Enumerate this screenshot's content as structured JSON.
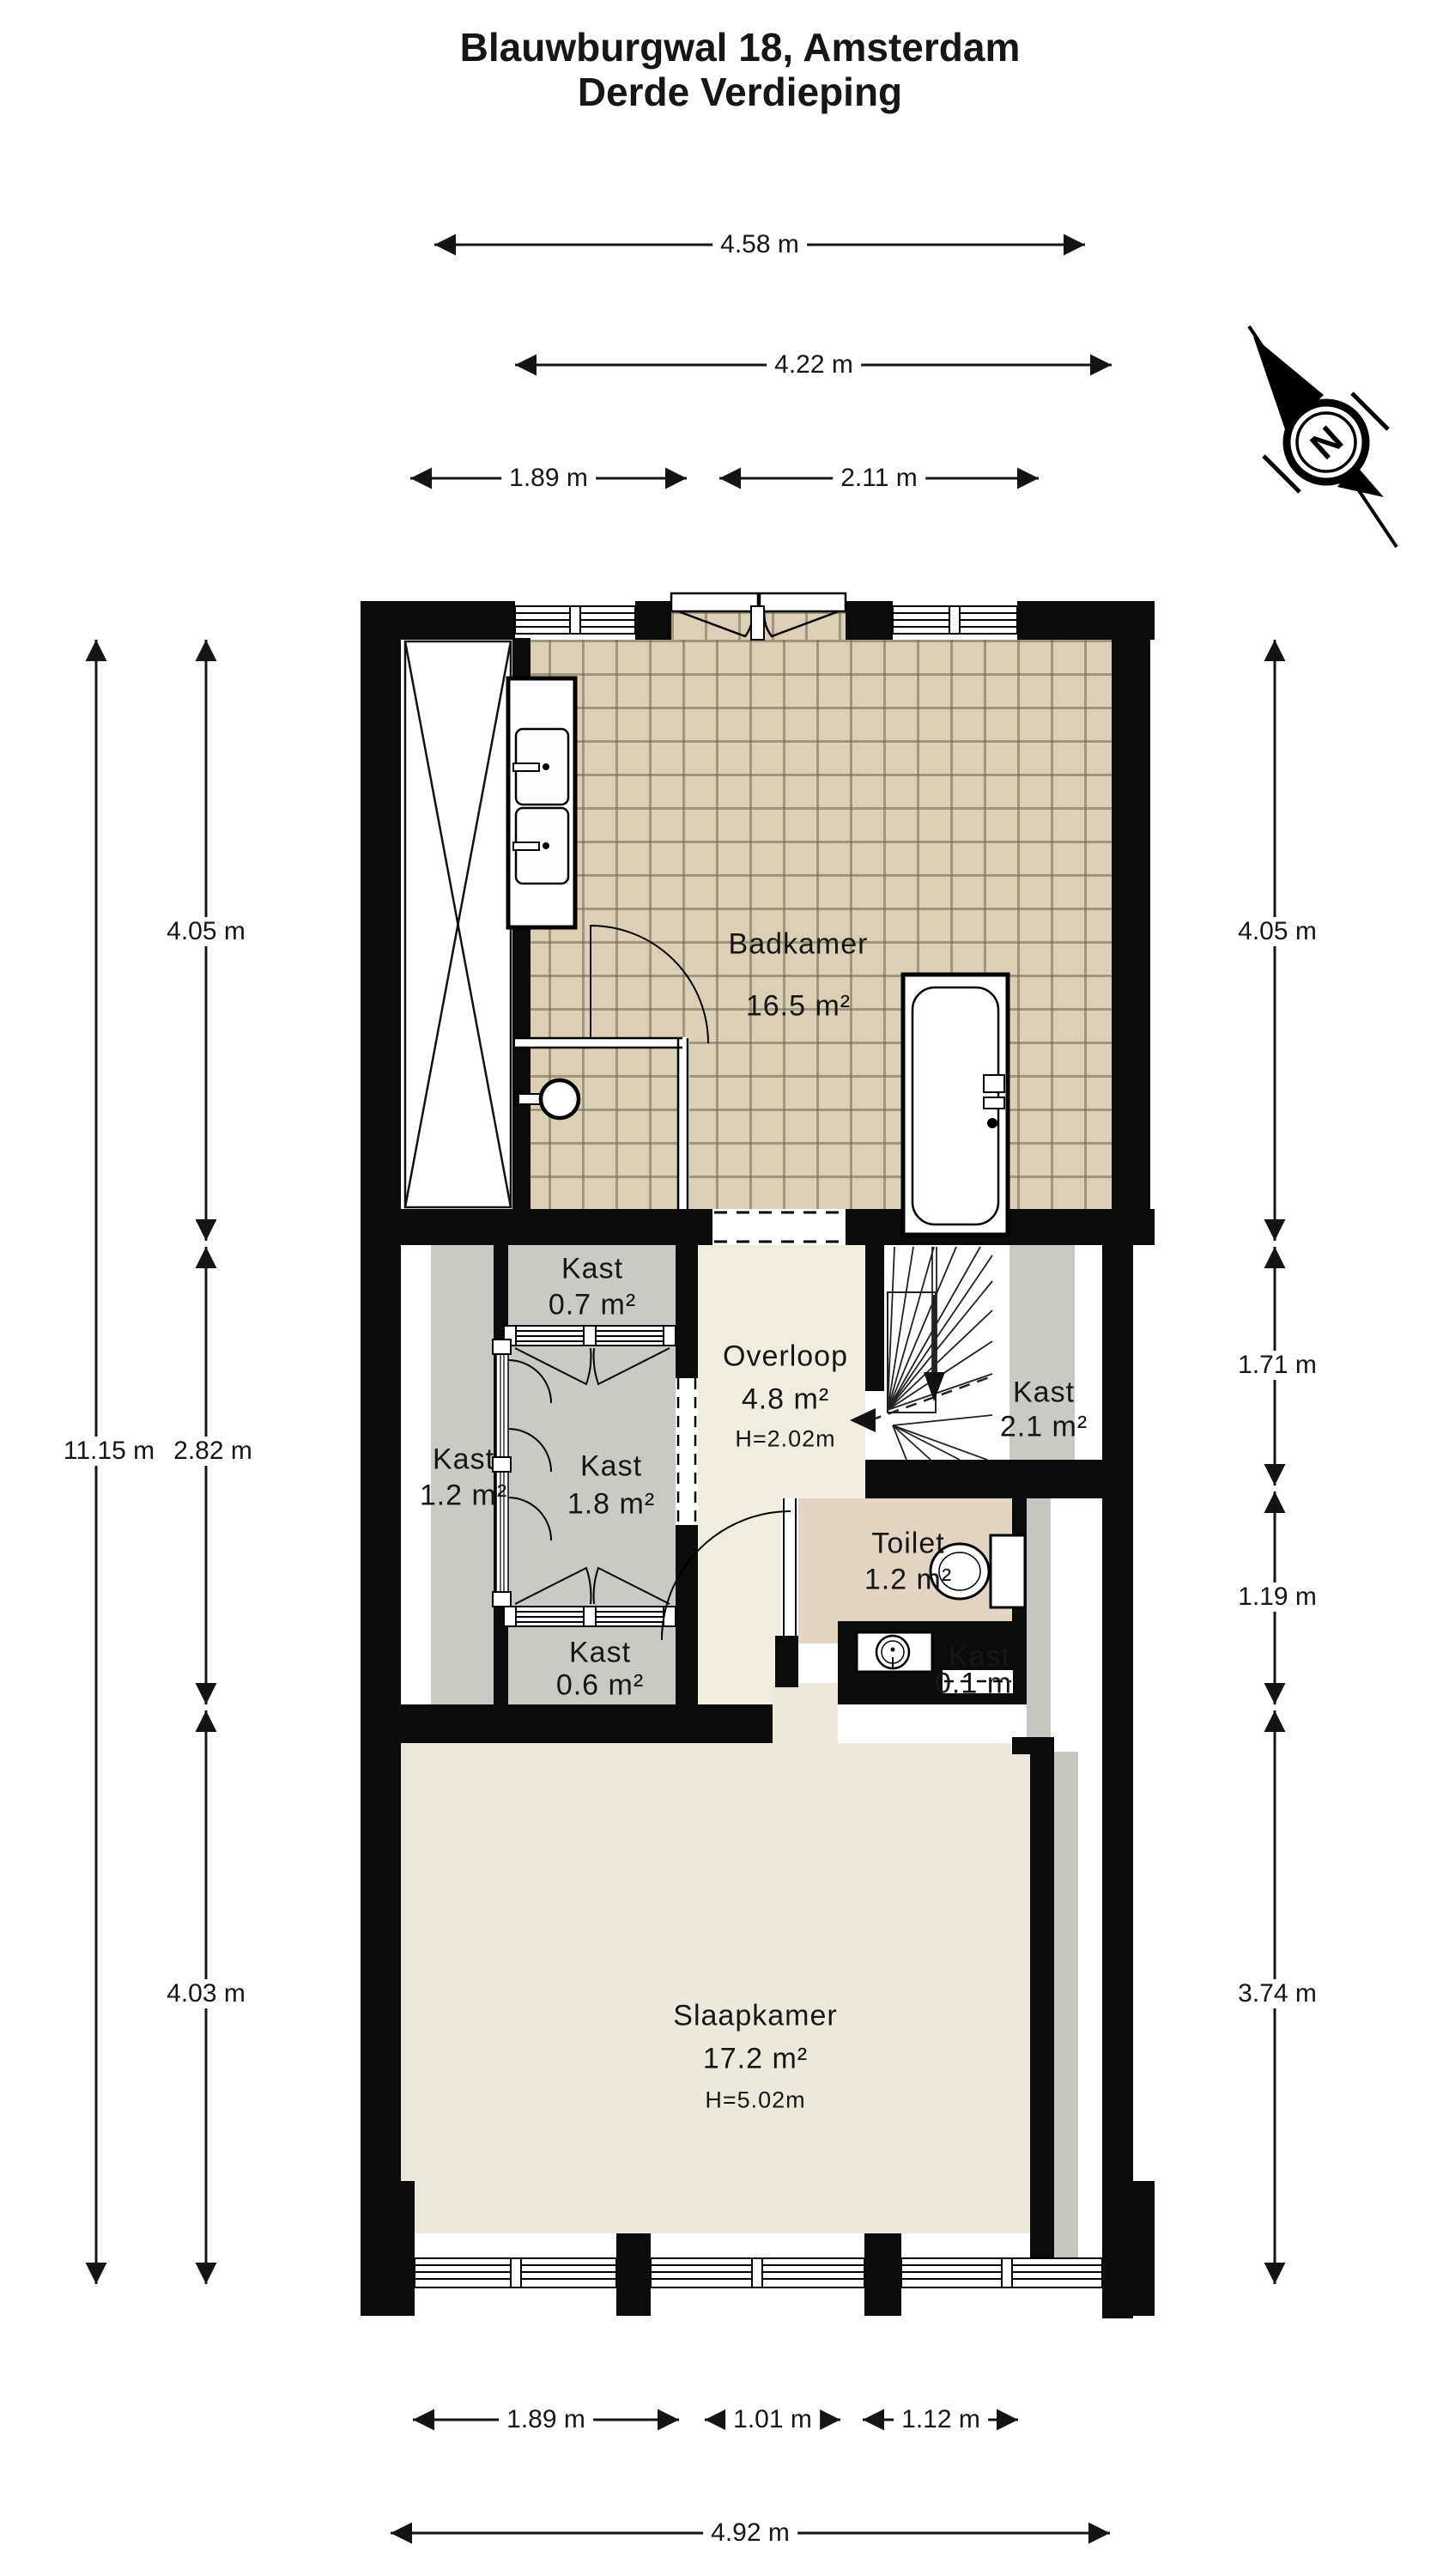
{
  "title": {
    "line1": "Blauwburgwal 18, Amsterdam",
    "line2": "Derde Verdieping"
  },
  "compass": {
    "letter": "N"
  },
  "rooms": {
    "badkamer": {
      "name": "Badkamer",
      "area": "16.5 m²"
    },
    "kast_07": {
      "name": "Kast",
      "area": "0.7 m²"
    },
    "kast_12": {
      "name": "Kast",
      "area": "1.2 m²"
    },
    "kast_18": {
      "name": "Kast",
      "area": "1.8 m²"
    },
    "kast_06": {
      "name": "Kast",
      "area": "0.6 m²"
    },
    "overloop": {
      "name": "Overloop",
      "area": "4.8 m²",
      "height": "H=2.02m"
    },
    "kast_21": {
      "name": "Kast",
      "area": "2.1 m²"
    },
    "toilet": {
      "name": "Toilet",
      "area": "1.2 m²"
    },
    "kast_01": {
      "name": "Kast",
      "area": "0.1 m"
    },
    "slaapkamer": {
      "name": "Slaapkamer",
      "area": "17.2 m²",
      "height": "H=5.02m"
    }
  },
  "dimensions": {
    "top": [
      "4.58 m",
      "4.22 m",
      "1.89 m",
      "2.11 m"
    ],
    "left": [
      "4.05 m",
      "11.15 m",
      "2.82 m",
      "4.03 m"
    ],
    "right": [
      "4.05 m",
      "1.71 m",
      "1.19 m",
      "3.74 m"
    ],
    "bottom": [
      "1.89 m",
      "1.01 m",
      "1.12 m",
      "4.92 m"
    ]
  }
}
